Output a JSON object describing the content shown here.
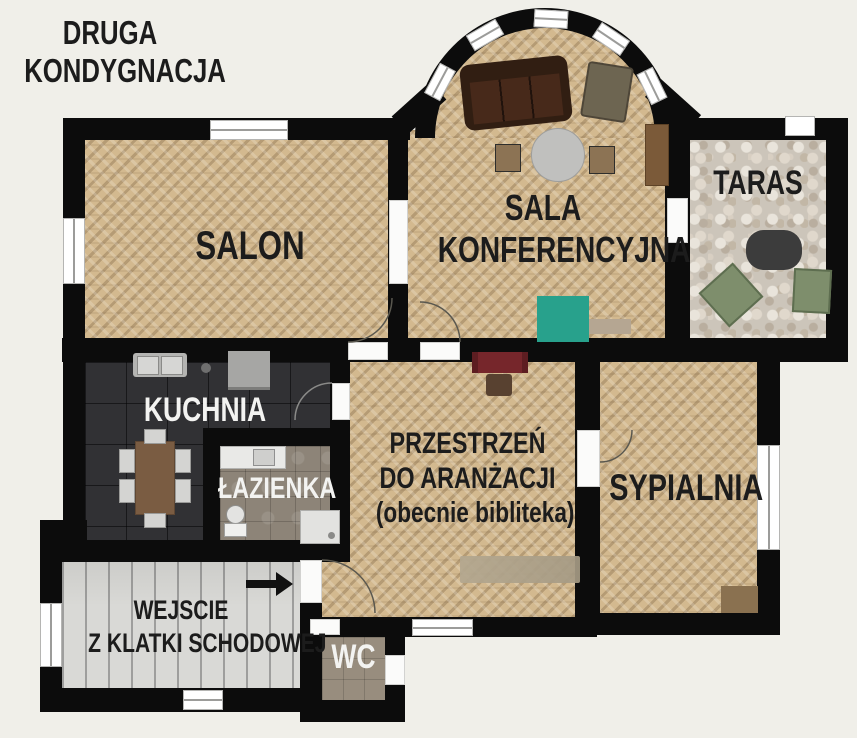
{
  "title": {
    "line1": "DRUGA",
    "line2": "KONDYGNACJA"
  },
  "rooms": {
    "salon": {
      "label": "SALON"
    },
    "sala_konferencyjna": {
      "line1": "SALA",
      "line2": "KONFERENCYJNA"
    },
    "taras": {
      "label": "TARAS"
    },
    "kuchnia": {
      "label": "KUCHNIA"
    },
    "lazienka": {
      "label": "ŁAZIENKA"
    },
    "przestrzen": {
      "line1": "PRZESTRZEŃ",
      "line2": "DO ARANŻACJI",
      "line3": "(obecnie bibliteka)"
    },
    "sypialnia": {
      "label": "SYPIALNIA"
    },
    "wejscie": {
      "line1": "WEJSCIE",
      "line2": "Z KLATKI SCHODOWEJ"
    },
    "wc": {
      "label": "WC"
    }
  },
  "colors": {
    "background": "#f0efe9",
    "wall": "#0c0c0c",
    "parquet": "#d3b98f",
    "kitchen_floor": "#313134",
    "bathroom_floor": "#8d8478",
    "terrace_stone": "#ccc5ba",
    "stairs": "#d9d9d6",
    "teal_rug": "#28a18c",
    "desk_red": "#76262b",
    "sofa_brown": "#311e12",
    "label_dark": "#1c1c1c",
    "label_light": "#f3f3f1"
  }
}
